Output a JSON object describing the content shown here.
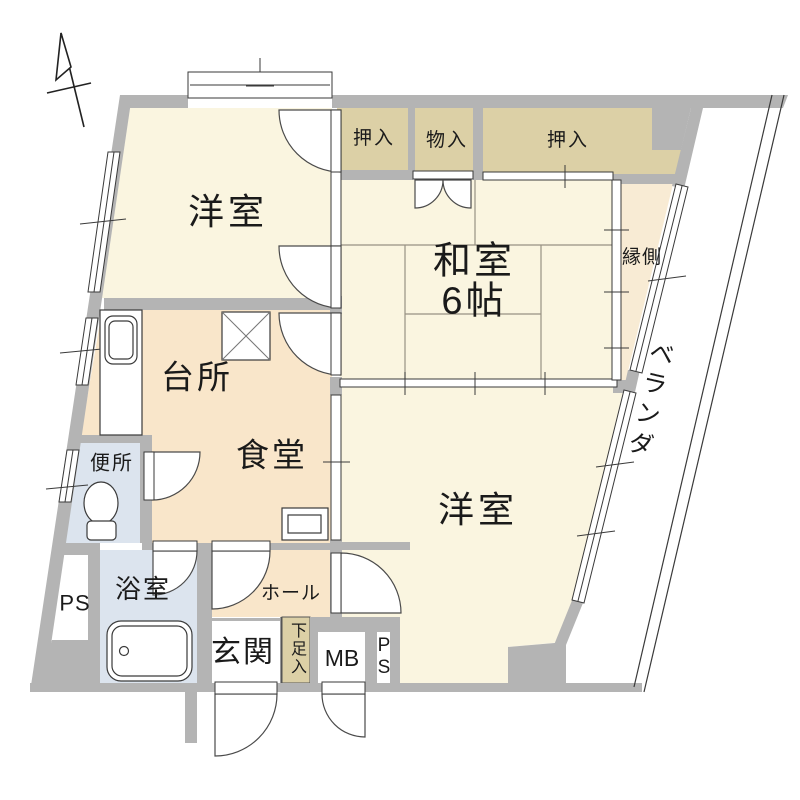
{
  "title": "apartment-floor-plan",
  "colors": {
    "wall": "#b4b4b4",
    "room": "#faf5e0",
    "service": "#f9e6ca",
    "closet": "#dcd0a6",
    "wet": "#dce4ee",
    "engawa": "#f8ebd4",
    "line": "#3a3a3a"
  },
  "rooms": {
    "western_room_1": {
      "label": "洋室"
    },
    "closet_1": {
      "label": "押入"
    },
    "storage": {
      "label": "物入"
    },
    "closet_2": {
      "label": "押入"
    },
    "japanese_room": {
      "label": "和室\n6帖"
    },
    "engawa": {
      "label": "縁側"
    },
    "veranda": {
      "label": "ベランダ"
    },
    "kitchen": {
      "label": "台所"
    },
    "dining": {
      "label": "食堂"
    },
    "toilet": {
      "label": "便所"
    },
    "bath": {
      "label": "浴室"
    },
    "pipe_space_left": {
      "label": "PS"
    },
    "hall": {
      "label": "ホール"
    },
    "entrance": {
      "label": "玄関"
    },
    "shoe_cabinet": {
      "label": "下足入"
    },
    "meter_box": {
      "label": "MB"
    },
    "pipe_space_right": {
      "label": "P\nS"
    },
    "western_room_2": {
      "label": "洋室"
    }
  }
}
